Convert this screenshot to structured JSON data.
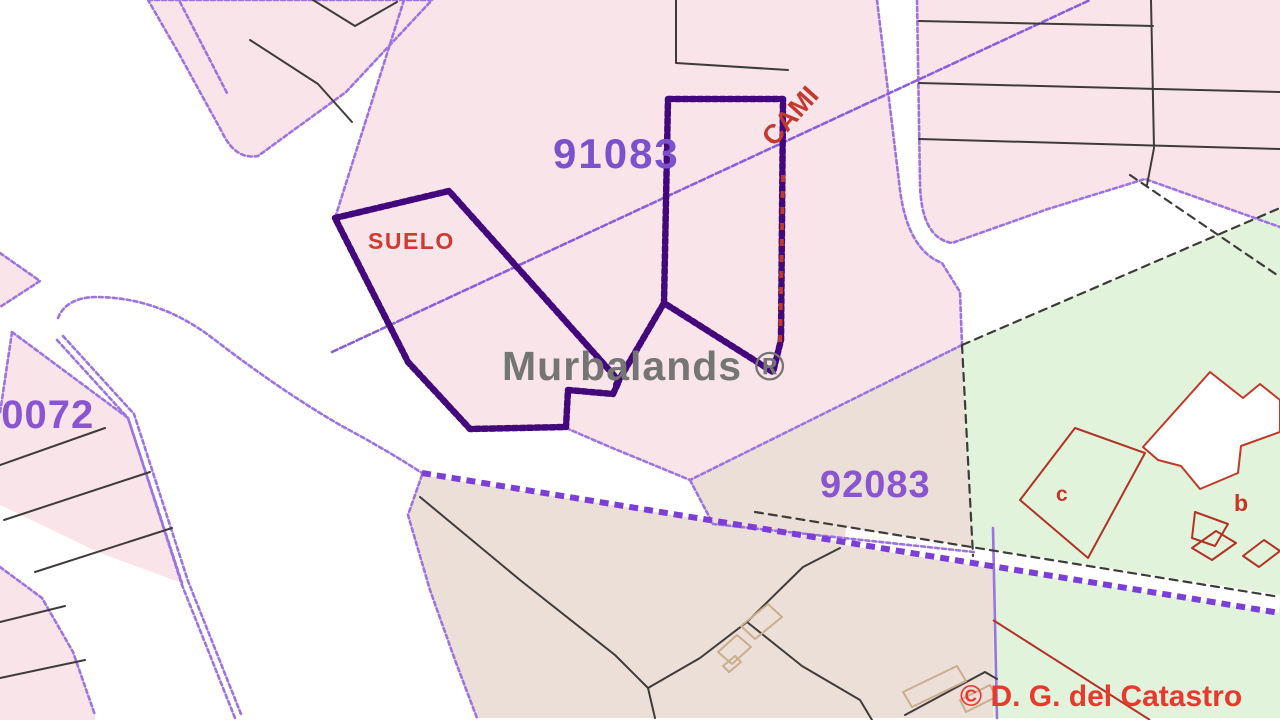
{
  "map": {
    "type": "cadastral-parcel-map",
    "watermark": "Murbalands ®",
    "attribution": "© D. G. del Catastro",
    "labels": {
      "parcel_91083": "91083",
      "parcel_92083": "92083",
      "parcel_90072": "90072",
      "selected_parcel_tag": "SUELO",
      "road_name": "CAMI",
      "building_c": "c",
      "building_b": "b"
    },
    "colors": {
      "parcel_fill_pink": "#f9e5e9",
      "parcel_fill_tan": "#ecdfd7",
      "parcel_fill_green": "#e2f3dc",
      "parcel_edge_purple": "#9d74dd",
      "selected_boundary_dark_purple": "#42087c",
      "road_centerline_purple": "#7b3fd8",
      "parcel_number_purple": "#8a55d0",
      "parcel_number_91083_purple": "#7b52cc",
      "red_label": "#d03a30",
      "road_label_red": "#c3392f",
      "building_outline_red": "#c0392b",
      "building_letter_red": "#cc3327",
      "attribution_red": "#e8392e",
      "watermark_gray": "#757575",
      "black_boundary": "#3f3b3b",
      "tan_building_outline": "#c9ae8e"
    }
  }
}
